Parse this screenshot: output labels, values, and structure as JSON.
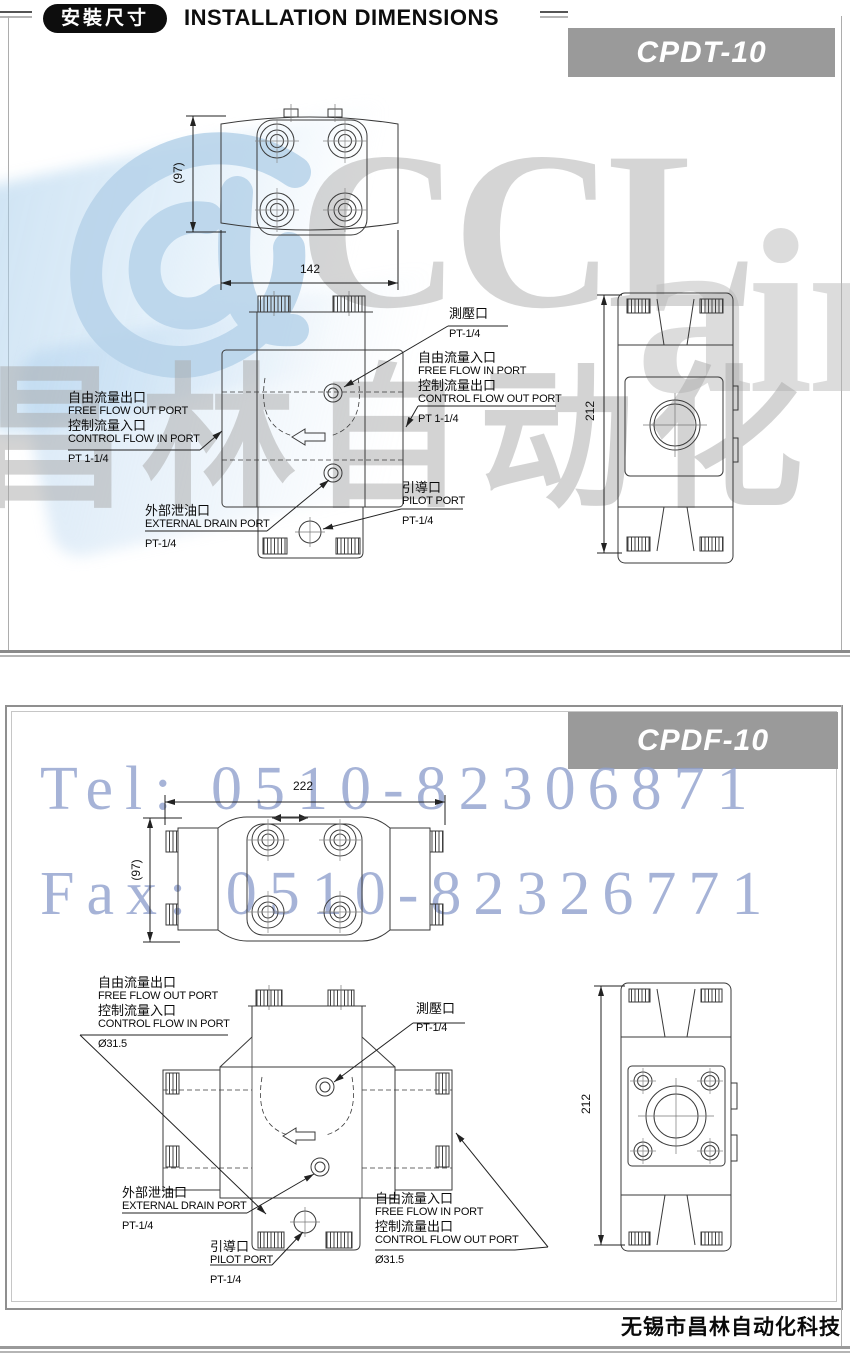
{
  "header": {
    "badge": "安裝尺寸",
    "title": "INSTALLATION DIMENSIONS"
  },
  "watermarks": {
    "logo_text": "CCL",
    "logo_text2": "air",
    "cn_text": "昌林自动化",
    "tel": "Tel: 0510-82306871",
    "fax": "Fax: 0510-82326771"
  },
  "footer": {
    "company": "无锡市昌林自动化科技"
  },
  "colors": {
    "model_box": "#9a9a9a",
    "watermark_blue": "#b7d3ea",
    "watermark_gray": "#c6c6c6",
    "telfax_blue": "#909fcd",
    "drawing_line": "#3a3a3a"
  },
  "panel1": {
    "model": "CPDT-10",
    "dim_width": "142",
    "dim_depth": "(97)",
    "dim_height": "212",
    "labels": {
      "out_cn": "自由流量出口",
      "out_en": "FREE FLOW OUT PORT",
      "in_cn": "控制流量入口",
      "in_en": "CONTROL FLOW IN PORT",
      "in_size": "PT 1-1/4",
      "gauge_cn": "測壓口",
      "gauge_size": "PT-1/4",
      "ffin_cn": "自由流量入口",
      "ffin_en": "FREE FLOW IN PORT",
      "cfout_cn": "控制流量出口",
      "cfout_en": "CONTROL FLOW OUT PORT",
      "cfout_size": "PT 1-1/4",
      "drain_cn": "外部泄油口",
      "drain_en": "EXTERNAL DRAIN PORT",
      "drain_size": "PT-1/4",
      "pilot_cn": "引導口",
      "pilot_en": "PILOT PORT",
      "pilot_size": "PT-1/4"
    }
  },
  "panel2": {
    "model": "CPDF-10",
    "dim_width": "222",
    "dim_depth": "(97)",
    "dim_height": "212",
    "labels": {
      "out_cn": "自由流量出口",
      "out_en": "FREE FLOW OUT PORT",
      "in_cn": "控制流量入口",
      "in_en": "CONTROL FLOW IN PORT",
      "in_size": "Ø31.5",
      "gauge_cn": "測壓口",
      "gauge_size": "PT-1/4",
      "ffin_cn": "自由流量入口",
      "ffin_en": "FREE FLOW IN PORT",
      "cfout_cn": "控制流量出口",
      "cfout_en": "CONTROL FLOW OUT PORT",
      "cfout_size": "Ø31.5",
      "drain_cn": "外部泄油口",
      "drain_en": "EXTERNAL DRAIN PORT",
      "drain_size": "PT-1/4",
      "pilot_cn": "引導口",
      "pilot_en": "PILOT PORT",
      "pilot_size": "PT-1/4"
    }
  }
}
